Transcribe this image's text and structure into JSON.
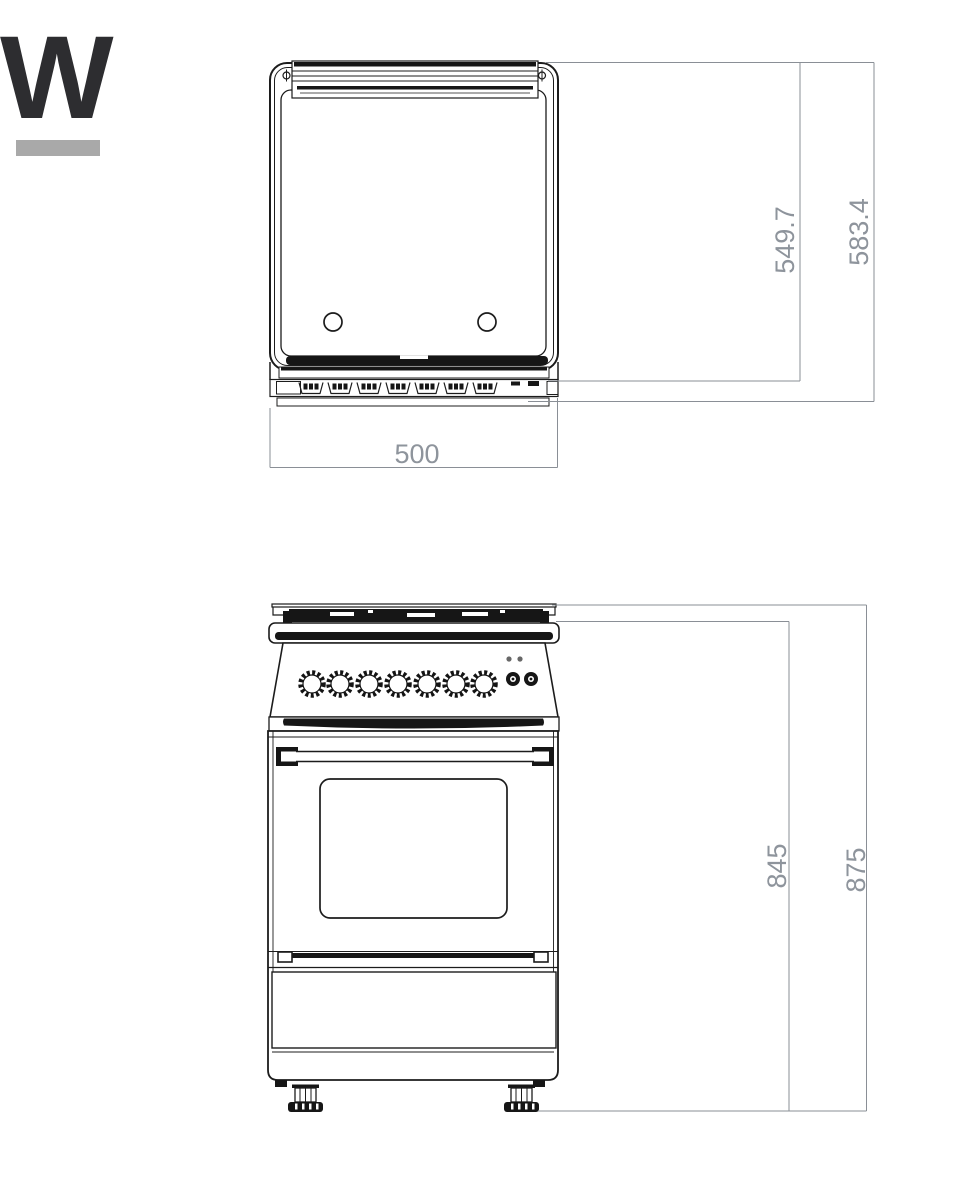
{
  "logo": {
    "letter": "W"
  },
  "colors": {
    "background": "#ffffff",
    "drawing_line": "#1c1c1c",
    "dimension_line": "#8a8f96",
    "dimension_text": "#8e949c",
    "logo_letter": "#2d2d30",
    "logo_bar": "#a9a9a9"
  },
  "drawing": {
    "subject": "freestanding cooker dimension drawing",
    "top_view": {
      "name": "top view",
      "dimensions": {
        "depth_inner": "549.7",
        "depth_overall": "583.4",
        "width": "500"
      }
    },
    "front_view": {
      "name": "front view",
      "dimensions": {
        "height_to_hob": "845",
        "height_overall": "875"
      }
    }
  }
}
